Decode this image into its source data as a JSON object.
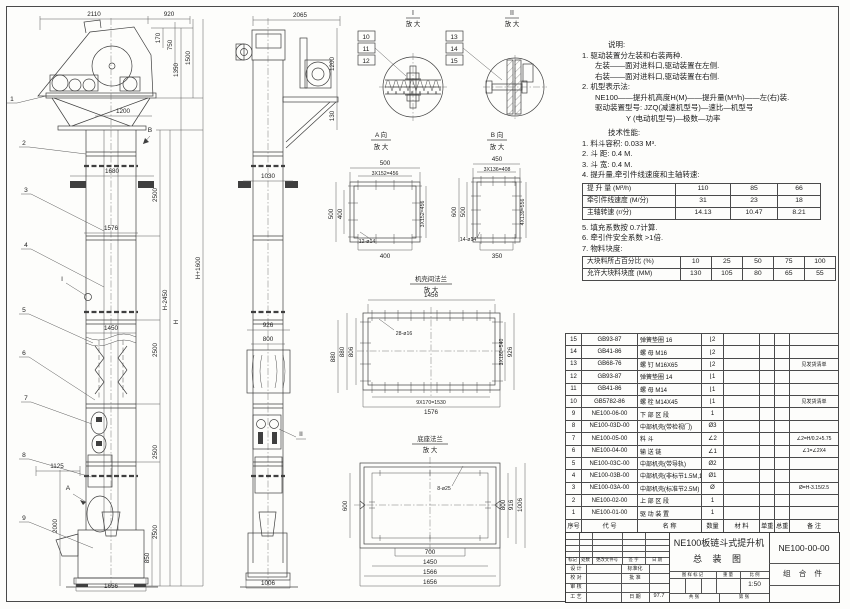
{
  "front_view": {
    "balloons": [
      "1",
      "2",
      "3",
      "4",
      "5",
      "6",
      "7",
      "8",
      "9"
    ],
    "label_i": "I",
    "label_a": "A",
    "label_b": "B",
    "dims": {
      "w2110": "2110",
      "w920": "920",
      "h170": "170",
      "h750": "750",
      "h1350": "1350",
      "h1500": "1500",
      "w1200": "1200",
      "w1680": "1680",
      "w1576": "1576",
      "w1450": "1450",
      "s2500a": "2500",
      "s2500b": "2500",
      "s2500c": "2500",
      "s2500d": "2500",
      "w1125": "1125",
      "h2000": "2000",
      "h850": "850",
      "w1656": "1656",
      "hh": "H",
      "hminus": "H-2450",
      "hplus": "H+1600"
    }
  },
  "side_view": {
    "label_ii": "II",
    "dims": {
      "w2065": "2065",
      "h1200": "1200",
      "h130": "130",
      "w1030": "1030",
      "w926": "926",
      "w800": "800",
      "h880": "880",
      "w1006": "1006"
    }
  },
  "detail_i": {
    "title": "I",
    "sub": "放 大",
    "balloons": [
      "10",
      "11",
      "12"
    ]
  },
  "detail_ii": {
    "title": "II",
    "sub": "放 大",
    "balloons": [
      "13",
      "14",
      "15"
    ]
  },
  "view_a": {
    "title": "A 向",
    "sub": "放 大",
    "dims": {
      "top1": "500",
      "top2": "3X152=456",
      "left1": "500",
      "left2": "400",
      "right": "3X152=456",
      "bottom": "400",
      "holes": "12-ø14"
    }
  },
  "view_b": {
    "title": "B 向",
    "sub": "放 大",
    "dims": {
      "top1": "450",
      "top2": "3X136=408",
      "left1": "600",
      "left2": "500",
      "right": "4X139=556",
      "bottom": "350",
      "holes": "14-ø14"
    }
  },
  "flange_mid": {
    "title": "机壳间法兰",
    "sub": "放 大",
    "dims": {
      "top": "1456",
      "holes": "28-ø16",
      "left1": "880",
      "left2": "806",
      "right1": "3X180=540",
      "right2": "926",
      "bottom1": "9X170=1530",
      "bottom2": "1576"
    }
  },
  "flange_base": {
    "title": "底座法兰",
    "sub": "放 大",
    "dims": {
      "holes": "8-ø25",
      "left": "600",
      "right1": "800",
      "right2": "916",
      "right3": "1006",
      "bottom1": "700",
      "bottom2": "1450",
      "bottom3": "1566",
      "bottom4": "1656"
    }
  },
  "notes": {
    "title": "说明:",
    "l1": "1. 驱动装置分左装和右装两种.",
    "l2": "左装——面对进料口,驱动装置在左侧.",
    "l3": "右装——面对进料口,驱动装置在右侧.",
    "l4": "2. 机型表示法:",
    "l5": "NE100——提升机高度H(M)——提升量(M³/h)——左(右)装.",
    "l6": "驱动装置型号: JZQ(减速机型号)—速比—机型号",
    "l7": "Y (电动机型号)—极数—功率"
  },
  "tech": {
    "title": "技术性能:",
    "t1": "1. 料斗容积: 0.033 M³.",
    "t2": "2. 斗  距: 0.4 M.",
    "t3": "3. 斗  宽: 0.4 M.",
    "t4": "4. 提升量,牵引件线速度和主轴转速:",
    "t5": "5. 填充系数按 0.7计算.",
    "t6": "6. 牵引件安全系数 >1倍.",
    "t7": "7. 物料块度:",
    "table1": [
      {
        "label": "提 升 量  (M³/h)",
        "c1": "110",
        "c2": "85",
        "c3": "66"
      },
      {
        "label": "牵引件线速度 (M/分)",
        "c1": "31",
        "c2": "23",
        "c3": "18"
      },
      {
        "label": "主轴转速  (r/分)",
        "c1": "14.13",
        "c2": "10.47",
        "c3": "8.21"
      }
    ],
    "table2": {
      "p_label": "大块料所占百分比 (%)",
      "p": [
        "10",
        "25",
        "50",
        "75",
        "100"
      ],
      "s_label": "允许大块料块度 (MM)",
      "s": [
        "130",
        "105",
        "80",
        "65",
        "55"
      ]
    }
  },
  "bom": {
    "header": {
      "no": "序号",
      "code": "代 号",
      "name": "名 称",
      "qty": "数量",
      "material": "材 料",
      "unit_w": "单重",
      "total_w": "总重",
      "remark": "备 注"
    },
    "rows": [
      {
        "no": "15",
        "code": "GB93-87",
        "name": "弹簧垫圈  16",
        "qty": "⌊2",
        "remark": ""
      },
      {
        "no": "14",
        "code": "GB41-86",
        "name": "螺 母  M16",
        "qty": "⌊2",
        "remark": ""
      },
      {
        "no": "13",
        "code": "GB68-76",
        "name": "螺 钉  M16X65",
        "qty": "⌊2",
        "remark": "见发货清单"
      },
      {
        "no": "12",
        "code": "GB93-87",
        "name": "弹簧垫圈  14",
        "qty": "⌊1",
        "remark": ""
      },
      {
        "no": "11",
        "code": "GB41-86",
        "name": "螺 母  M14",
        "qty": "⌊1",
        "remark": ""
      },
      {
        "no": "10",
        "code": "GB5782-86",
        "name": "螺 栓  M14X45",
        "qty": "⌊1",
        "remark": "见发货清单"
      },
      {
        "no": "9",
        "code": "NE100-06-00",
        "name": "下 部 区 段",
        "qty": "1",
        "remark": ""
      },
      {
        "no": "8",
        "code": "NE100-03D-00",
        "name": "中部机壳(带检视门)",
        "qty": "Ø3",
        "remark": ""
      },
      {
        "no": "7",
        "code": "NE100-05-00",
        "name": "料 斗",
        "qty": "∠2",
        "remark": "∠2=H/0.2+5.75"
      },
      {
        "no": "6",
        "code": "NE100-04-00",
        "name": "输 送 链",
        "qty": "∠1",
        "remark": "∠1=∠2X4"
      },
      {
        "no": "5",
        "code": "NE100-03C-00",
        "name": "中部机壳(带导轨)",
        "qty": "Ø2",
        "remark": ""
      },
      {
        "no": "4",
        "code": "NE100-03B-00",
        "name": "中部机壳(非标节1.5M,1M)",
        "qty": "Ø1",
        "remark": ""
      },
      {
        "no": "3",
        "code": "NE100-03A-00",
        "name": "中部机壳(标准节2.5M)",
        "qty": "Ø",
        "remark": "Ø=H-3.15/2.5"
      },
      {
        "no": "2",
        "code": "NE100-02-00",
        "name": "上 部 区 段",
        "qty": "1",
        "remark": ""
      },
      {
        "no": "1",
        "code": "NE100-01-00",
        "name": "驱 动 装 置",
        "qty": "1",
        "remark": ""
      }
    ]
  },
  "title_block": {
    "rev_labels": [
      "标记",
      "处数",
      "更改文件号",
      "签 字",
      "日 期"
    ],
    "roles": {
      "design": "设 计",
      "check": "校 对",
      "review": "审 核",
      "craft": "工 艺",
      "std": "标准化",
      "approve": "批 准",
      "date_label": "日 期",
      "date": "97.7"
    },
    "title1": "NE100板链斗式提升机",
    "title2": "总  装  图",
    "code": "NE100-00-00",
    "combo": "组 合 件",
    "mark_label": "图 样 标 记",
    "weight_label": "重 量",
    "scale_label": "比 例",
    "scale": "1:50",
    "sheet_total": "共  张",
    "sheet_no": "第  张"
  }
}
